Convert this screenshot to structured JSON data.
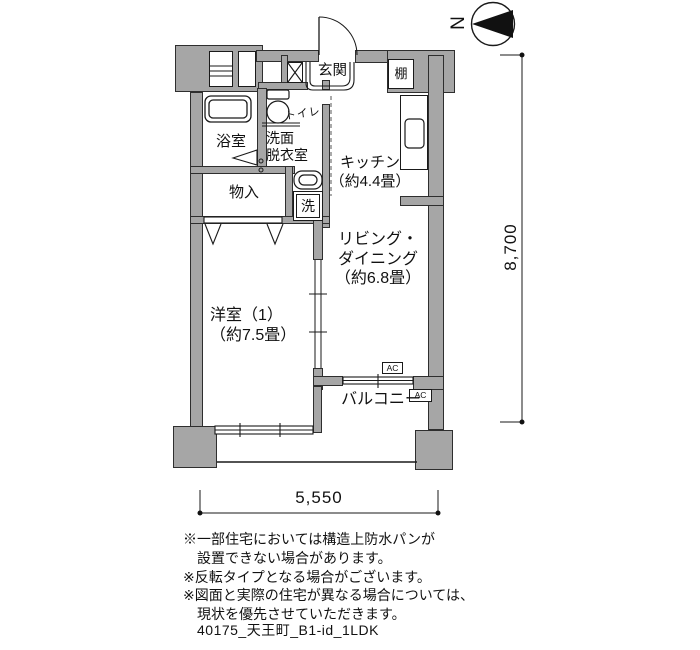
{
  "plan": {
    "north_label": "N",
    "rooms": {
      "genkan": "玄関",
      "shelf": "棚",
      "toilet": "トイレ",
      "washroom": "洗面\n脱衣室",
      "bath": "浴室",
      "storage": "物入",
      "washer": "洗",
      "kitchen": "キッチン\n（約4.4畳）",
      "living": "リビング・\nダイニング\n（約6.8畳）",
      "western_room": "洋室（1）\n（約7.5畳）",
      "balcony": "バルコニー",
      "ac_unit": "AC"
    },
    "dimensions": {
      "width": "5,550",
      "height": "8,700"
    },
    "notes": "※一部住宅においては構造上防水パンが\n　設置できない場合があります。\n※反転タイプとなる場合がございます。\n※図面と実際の住宅が異なる場合については、\n　現状を優先させていただきます。",
    "plan_id": "40175_天王町_B1-id_1LDK",
    "colors": {
      "wall": "#a6a6a6",
      "line": "#1a1a1a"
    }
  }
}
